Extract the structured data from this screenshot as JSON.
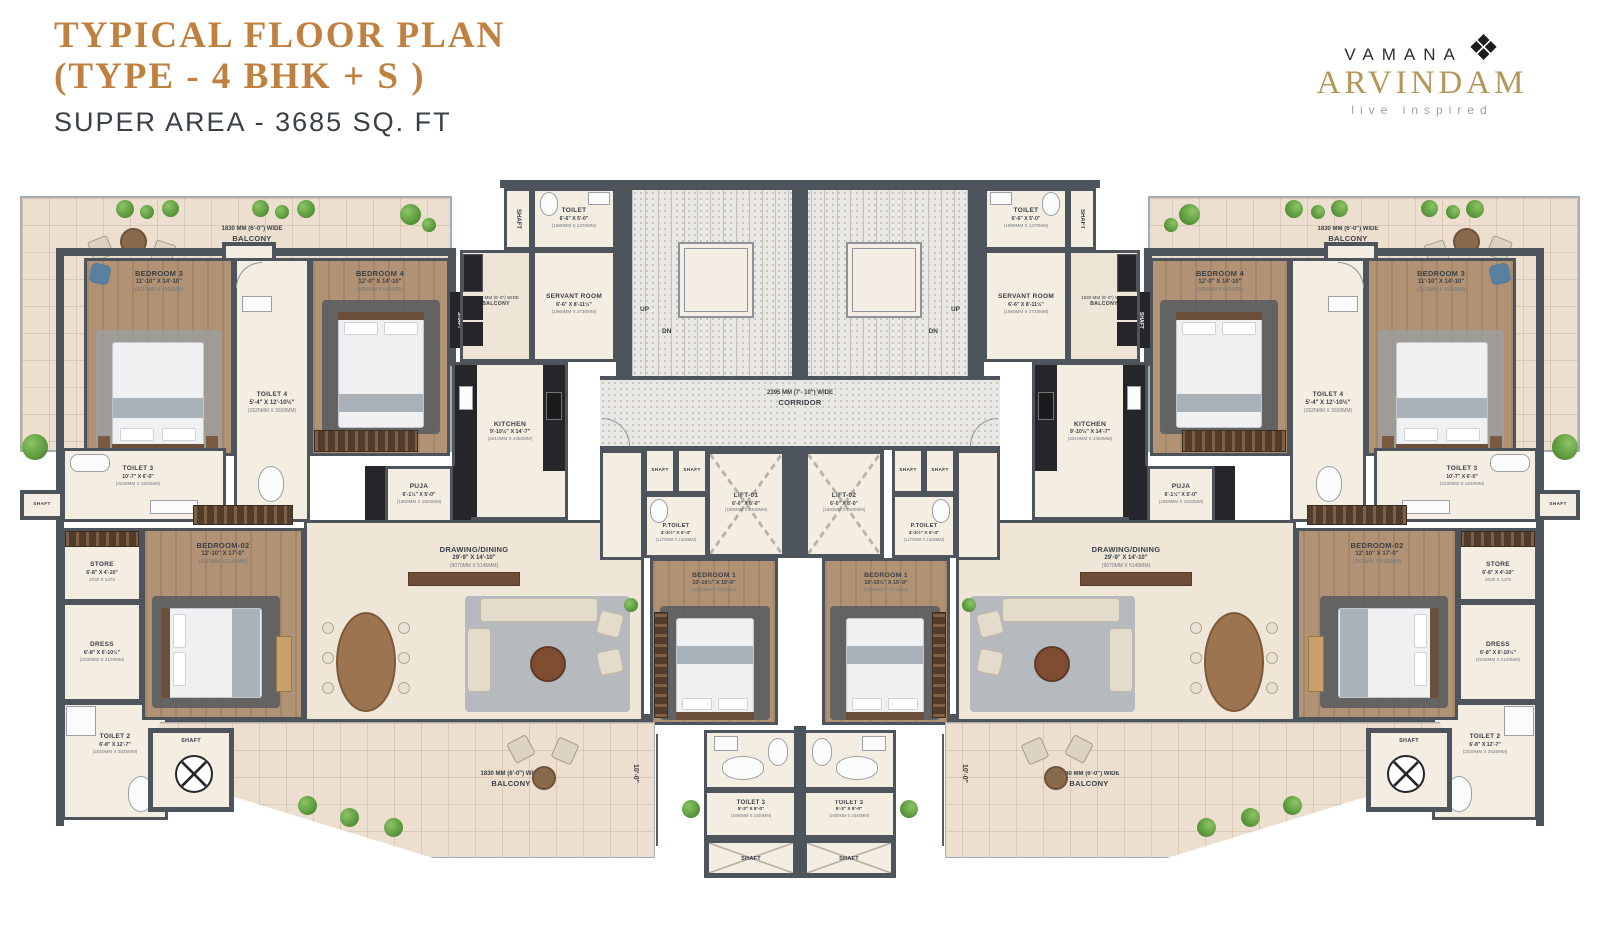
{
  "header": {
    "title_line1": "TYPICAL FLOOR PLAN",
    "title_line2": "(TYPE - 4 BHK + S )",
    "super_area": "SUPER AREA - 3685 SQ. FT"
  },
  "brand": {
    "name": "VAMANA",
    "product": "ARVINDAM",
    "tagline": "live inspired",
    "knot_icon": "❖",
    "gold_color": "#b49659",
    "title_color": "#c0803f"
  },
  "rooms": {
    "balcony": {
      "line1": "1830 MM (6'-0\") WIDE",
      "line2": "BALCONY"
    },
    "corridor": {
      "line1": "2395 MM (7'- 10\") WIDE",
      "line2": "CORRIDOR"
    },
    "bedroom3": {
      "label": "BEDROOM 3",
      "dims": "11'-10\" X 14'-10\"",
      "mm": "(3610MM X 4520MM)"
    },
    "toilet4": {
      "label": "TOILET 4",
      "dims": "5'-4\" X 12'-10½\"",
      "mm": "(1625MM X 3920MM)"
    },
    "bedroom4": {
      "label": "BEDROOM 4",
      "dims": "12'-0\" X 14'-10\"",
      "mm": "(3658MM X 4520MM)"
    },
    "servant_toilet": {
      "label": "TOILET",
      "dims": "6'-6\" X 5'-0\"",
      "mm": "(1980MM X 1370MM)"
    },
    "servant_room": {
      "label": "SERVANT ROOM",
      "dims": "6'-6\" X 8'-11½\"",
      "mm": "(1980MM X 2730MM)"
    },
    "kitchen": {
      "label": "KITCHEN",
      "dims": "9'-10½\" X 14'-7\"",
      "mm": "(3010MM X 4450MM)"
    },
    "puja": {
      "label": "PUJA",
      "dims": "6'-1½\" X 5'-0\"",
      "mm": "(1860MM X 1520MM)"
    },
    "toilet3_side": {
      "label": "TOILET 3",
      "dims": "10'-7\" X 6'-0\"",
      "mm": "(3230MM X 1830MM)"
    },
    "store": {
      "label": "STORE",
      "dims": "6'-8\" X 4'-10\"",
      "mm": "2030 X 1470"
    },
    "dress": {
      "label": "DRESS",
      "dims": "6'-8\" X 6'-10½\"",
      "mm": "(2030MM X 2100MM)"
    },
    "toilet2": {
      "label": "TOILET 2",
      "dims": "6'-8\" X 12'-7\"",
      "mm": "(2030MM X 3835MM)"
    },
    "bedroom02": {
      "label": "BEDROOM-02",
      "dims": "12'-10\" X 17'-0\"",
      "mm": "(3910MM X 5180MM)"
    },
    "drawing_dining": {
      "label": "DRAWING/DINING",
      "dims": "29'-9\" X 14'-10\"",
      "mm": "(9070MM X 5145MM)"
    },
    "bedroom1": {
      "label": "BEDROOM 1",
      "dims": "10'-10½\" X 15'-0\"",
      "mm": "(3330MM X 4570MM)"
    },
    "p_toilet": {
      "label": "P.TOILET",
      "dims": "4'-2½\" X 5'-4\"",
      "mm": "(1270MM X 1625MM)"
    },
    "lift01": {
      "label": "LIFT-01",
      "dims": "6'-0\" X 8'-0\"",
      "mm": "(1800MM X 2400MM)"
    },
    "lift02": {
      "label": "LIFT-02",
      "dims": "6'-0\" X 8'-0\"",
      "mm": "(1800MM X 2400MM)"
    },
    "toilet3_bottom": {
      "label": "TOILET 3",
      "dims": "5'-3\" X 8'-0\"",
      "mm": "(1600MM X 2440MM)"
    }
  },
  "labels": {
    "shaft": "SHAFT",
    "up": "UP",
    "dn": "DN",
    "dim10": "10'-0\""
  }
}
